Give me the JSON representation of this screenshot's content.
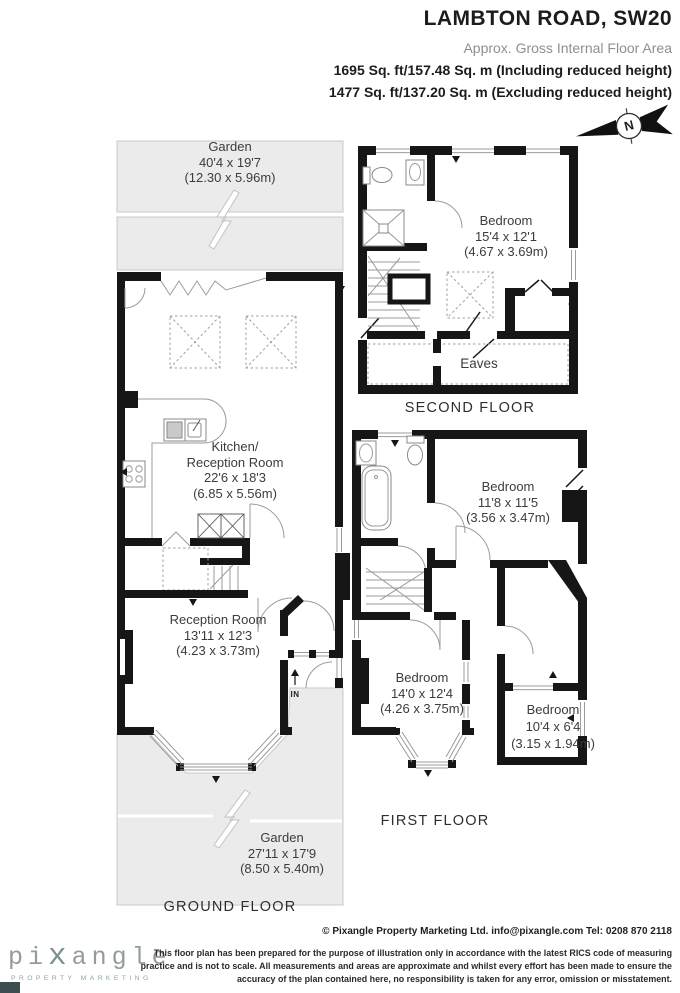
{
  "header": {
    "title": "LAMBTON ROAD, SW20",
    "subtitle": "Approx. Gross Internal Floor Area",
    "area_line1": "1695 Sq. ft/157.48 Sq. m (Including reduced height)",
    "area_line2": "1477 Sq. ft/137.20 Sq. m (Excluding reduced height)"
  },
  "compass_label": "N",
  "ground_floor": {
    "label": "GROUND FLOOR",
    "garden_top": {
      "name": "Garden",
      "imperial": "40'4 x 19'7",
      "metric": "(12.30 x 5.96m)"
    },
    "kitchen_reception": {
      "line1": "Kitchen/",
      "line2": "Reception Room",
      "imperial": "22'6 x 18'3",
      "metric": "(6.85 x 5.56m)"
    },
    "reception": {
      "name": "Reception Room",
      "imperial": "13'11 x 12'3",
      "metric": "(4.23 x 3.73m)"
    },
    "garden_bottom": {
      "name": "Garden",
      "imperial": "27'11 x 17'9",
      "metric": "(8.50 x 5.40m)"
    },
    "entrance": "IN"
  },
  "first_floor": {
    "label": "FIRST FLOOR",
    "bedroom_middle": {
      "name": "Bedroom",
      "imperial": "11'8 x 11'5",
      "metric": "(3.56 x 3.47m)"
    },
    "bedroom_front": {
      "name": "Bedroom",
      "imperial": "14'0 x 12'4",
      "metric": "(4.26 x 3.75m)"
    },
    "bedroom_back": {
      "name": "Bedroom",
      "imperial": "10'4 x 6'4",
      "metric": "(3.15 x 1.94m)"
    }
  },
  "second_floor": {
    "label": "SECOND FLOOR",
    "bedroom": {
      "name": "Bedroom",
      "imperial": "15'4 x 12'1",
      "metric": "(4.67 x 3.69m)"
    },
    "eaves": "Eaves"
  },
  "footer": {
    "logo": {
      "part1": "pi",
      "part2": "x",
      "part3": "angle",
      "tagline": "PROPERTY MARKETING"
    },
    "copyright": "© Pixangle Property Marketing Ltd. info@pixangle.com Tel: 0208 870 2118",
    "disclaimer": "This floor plan has been prepared for the purpose of illustration only in accordance with the latest RICS code of measuring practice and is not to scale. All measurements and areas are approximate and whilst every effort has been made to ensure the accuracy of the plan contained here, no responsibility is taken for any error, omission or misstatement."
  },
  "colors": {
    "wall": "#161616",
    "garden_fill": "#ebebeb",
    "garden_border": "#c9c9c9",
    "text": "#3c3c3c",
    "logo_gray": "#939c9c",
    "logo_teal": "#8fa6a6"
  }
}
